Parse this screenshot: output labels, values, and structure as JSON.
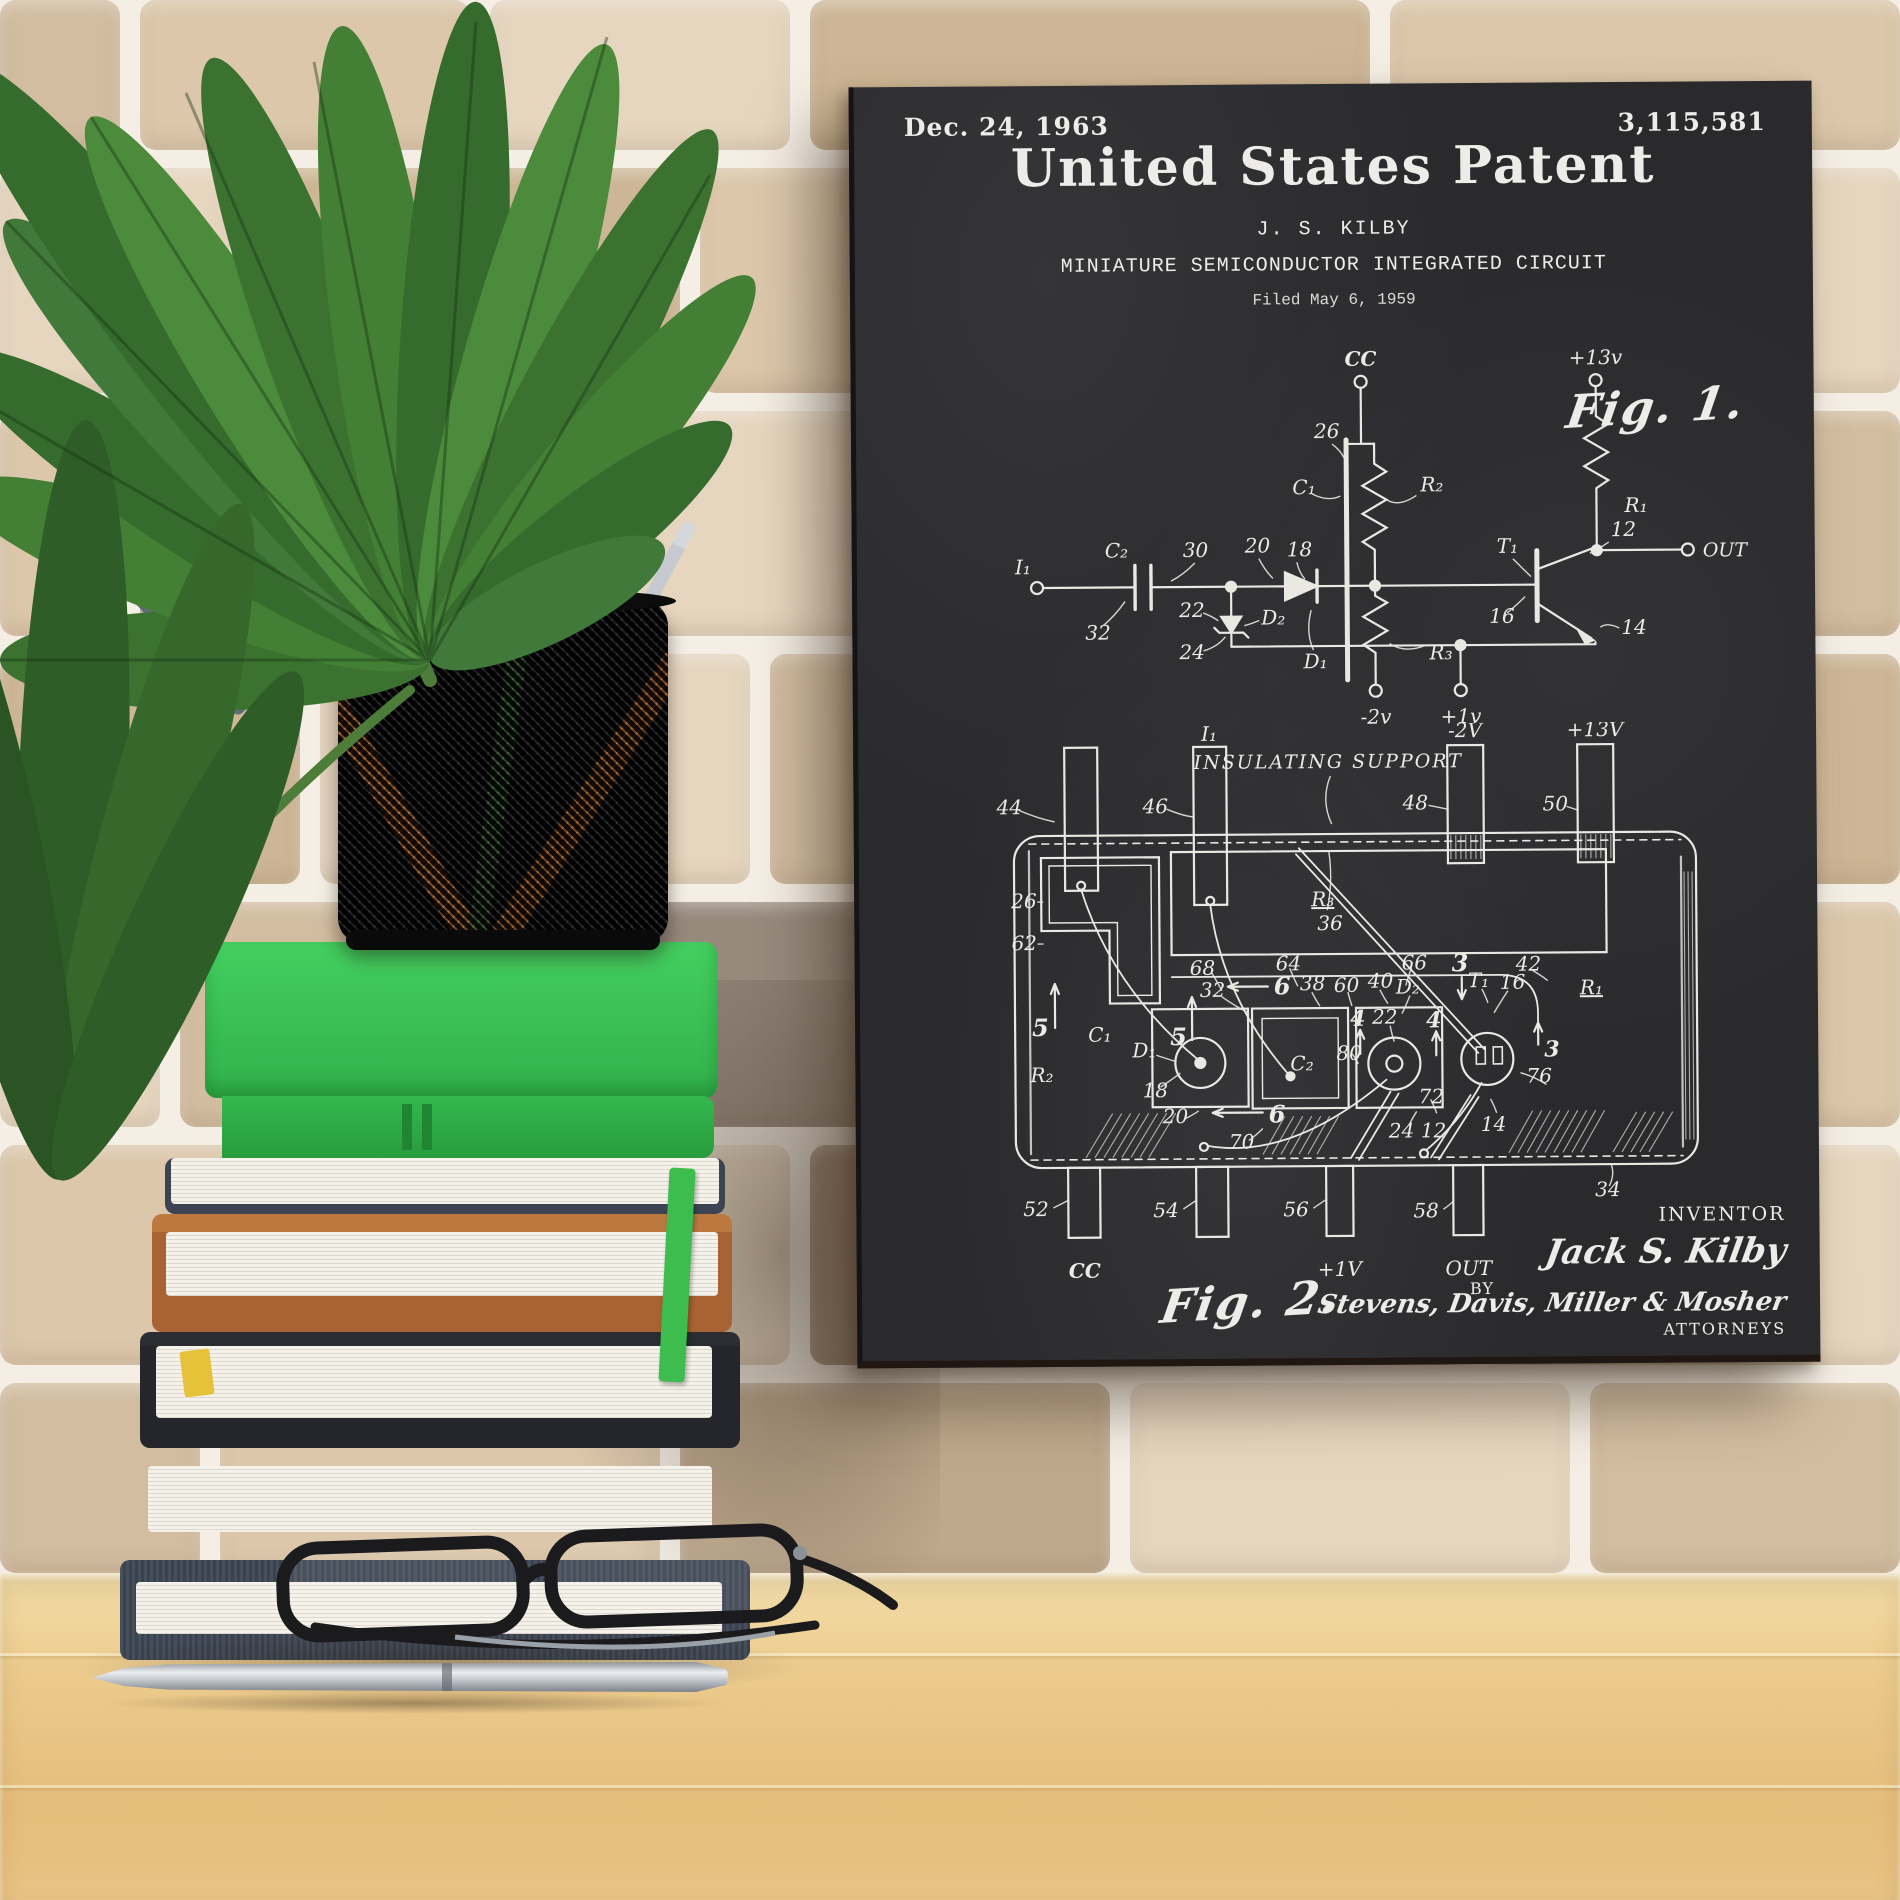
{
  "palette": {
    "mortar": "#f4eee4",
    "board": "#2a2a2d",
    "chalk": "#edece8",
    "desk": "#eccb8d",
    "leaf": "#3f7a33",
    "book_green": "#2fae46",
    "book_tan": "#b06a33",
    "book_brown": "#4a3429",
    "book_navy": "#3a4250",
    "pencil_orange": "#d8782a"
  },
  "poster": {
    "header": {
      "date": "Dec. 24, 1963",
      "number": "3,115,581",
      "title": "United States Patent",
      "inventor": "J. S. KILBY",
      "subtitle": "MINIATURE SEMICONDUCTOR INTEGRATED CIRCUIT",
      "filed": "Filed May 6, 1959"
    },
    "fig1": {
      "caption": "Fig. 1.",
      "labels": {
        "cc": "CC",
        "v13": "+13v",
        "r1": "R₁",
        "out": "OUT",
        "i1": "I₁",
        "c2": "C₂",
        "n30": "30",
        "n32": "32",
        "n20": "20",
        "n18": "18",
        "n26": "26",
        "c1": "C₁",
        "r2": "R₂",
        "t1": "T₁",
        "n12": "12",
        "n16": "16",
        "n14": "14",
        "n22": "22",
        "d2": "D₂",
        "n24": "24",
        "d1": "D₁",
        "r3": "R₃",
        "vneg2": "-2v",
        "vpos1": "+1v"
      }
    },
    "fig2": {
      "caption": "Fig. 2.",
      "labels": {
        "i1": "I₁",
        "vneg2": "-2V",
        "v13": "+13V",
        "n44": "44",
        "n46": "46",
        "n48": "48",
        "n50": "50",
        "support": "INSULATING SUPPORT",
        "n36": "36",
        "n26": "26",
        "n62": "62",
        "r3": "R₃",
        "n68": "68",
        "n64": "64",
        "n66": "66",
        "n42": "42",
        "n5a": "5",
        "n5b": "5",
        "c1": "C₁",
        "r2": "R₂",
        "d1": "D₁",
        "n18": "18",
        "n32": "32",
        "n6a": "6",
        "n38": "38",
        "n60": "60",
        "n40": "40",
        "d2": "D₂",
        "n3a": "3",
        "t1": "T₁",
        "n16": "16",
        "r1": "R₁",
        "n4a": "4",
        "n22": "22",
        "n4b": "4",
        "n3b": "3",
        "c2": "C₂",
        "n20": "20",
        "n6b": "6",
        "n70": "70",
        "n80": "80",
        "n24": "24",
        "n72": "72",
        "n12": "12",
        "n14": "14",
        "n76": "76",
        "n52": "52",
        "n54": "54",
        "n56": "56",
        "n58": "58",
        "n34": "34",
        "cc": "CC",
        "vpos1": "+1V",
        "out": "OUT"
      }
    },
    "signature": {
      "inventor_label": "INVENTOR",
      "inventor_name": "Jack S. Kilby",
      "by": "BY",
      "attorneys": "Stevens, Davis, Miller & Mosher",
      "attorneys_label": "ATTORNEYS"
    }
  }
}
